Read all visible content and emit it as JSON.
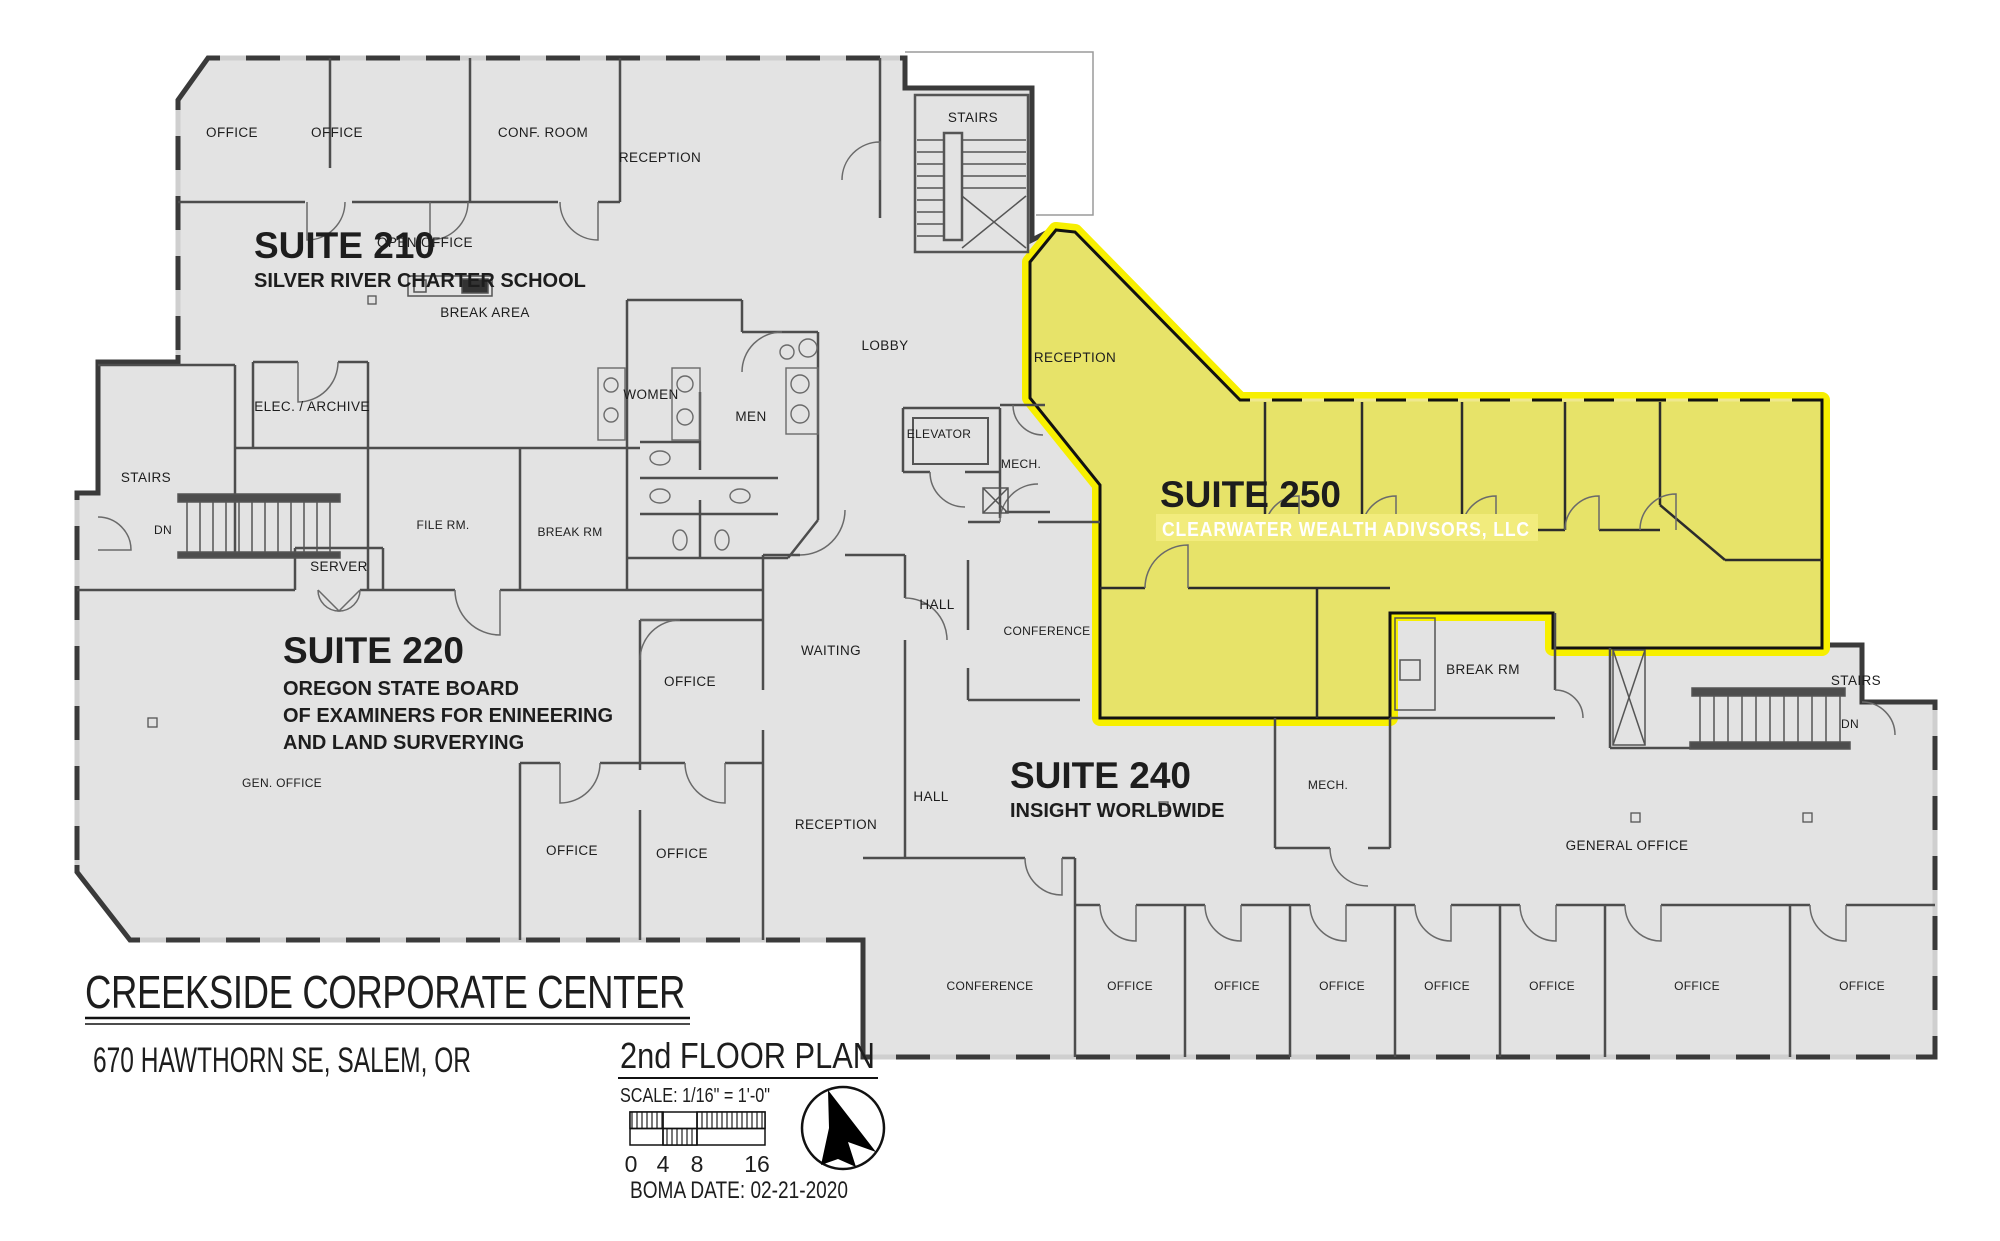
{
  "plan": {
    "building_name": "CREEKSIDE CORPORATE CENTER",
    "address": "670 HAWTHORN SE, SALEM, OR",
    "drawing_title": "2nd FLOOR PLAN",
    "scale_note": "SCALE: 1/16\" = 1'-0\"",
    "boma_date": "BOMA DATE: 02-21-2020",
    "scale_ticks": [
      "0",
      "4",
      "8",
      "16"
    ],
    "colors": {
      "highlight_border": "#f7ef00",
      "highlight_fill": "#e7e369",
      "building_fill": "#e3e3e3",
      "wall": "#3a3a3a"
    },
    "icons": {
      "north_arrow": "north-arrow"
    }
  },
  "suites": {
    "s210": {
      "number": "SUITE 210",
      "tenant": "SILVER RIVER CHARTER SCHOOL"
    },
    "s220": {
      "number": "SUITE 220",
      "tenant_line1": "OREGON STATE BOARD",
      "tenant_line2": "OF EXAMINERS FOR ENINEERING",
      "tenant_line3": "AND LAND SURVERYING"
    },
    "s240": {
      "number": "SUITE 240",
      "tenant": "INSIGHT WORLDWIDE"
    },
    "s250": {
      "number": "SUITE 250",
      "tenant": "CLEARWATER WEALTH ADIVSORS, LLC"
    }
  },
  "rooms": [
    "OFFICE",
    "OFFICE",
    "CONF. ROOM",
    "RECEPTION",
    "STAIRS",
    "OPEN OFFICE",
    "BREAK AREA",
    "LOBBY",
    "WOMEN",
    "MEN",
    "ELEC. / ARCHIVE",
    "STAIRS",
    "DN",
    "FILE RM.",
    "BREAK RM",
    "SERVER",
    "ELEVATOR",
    "MECH.",
    "HALL",
    "CONFERENCE",
    "RECEPTION",
    "WAITING",
    "GEN. OFFICE",
    "OFFICE",
    "OFFICE",
    "OFFICE",
    "HALL",
    "RECEPTION",
    "MECH.",
    "BREAK RM",
    "STAIRS",
    "DN",
    "GENERAL OFFICE",
    "CONFERENCE",
    "OFFICE",
    "OFFICE",
    "OFFICE",
    "OFFICE",
    "OFFICE",
    "OFFICE",
    "OFFICE"
  ]
}
